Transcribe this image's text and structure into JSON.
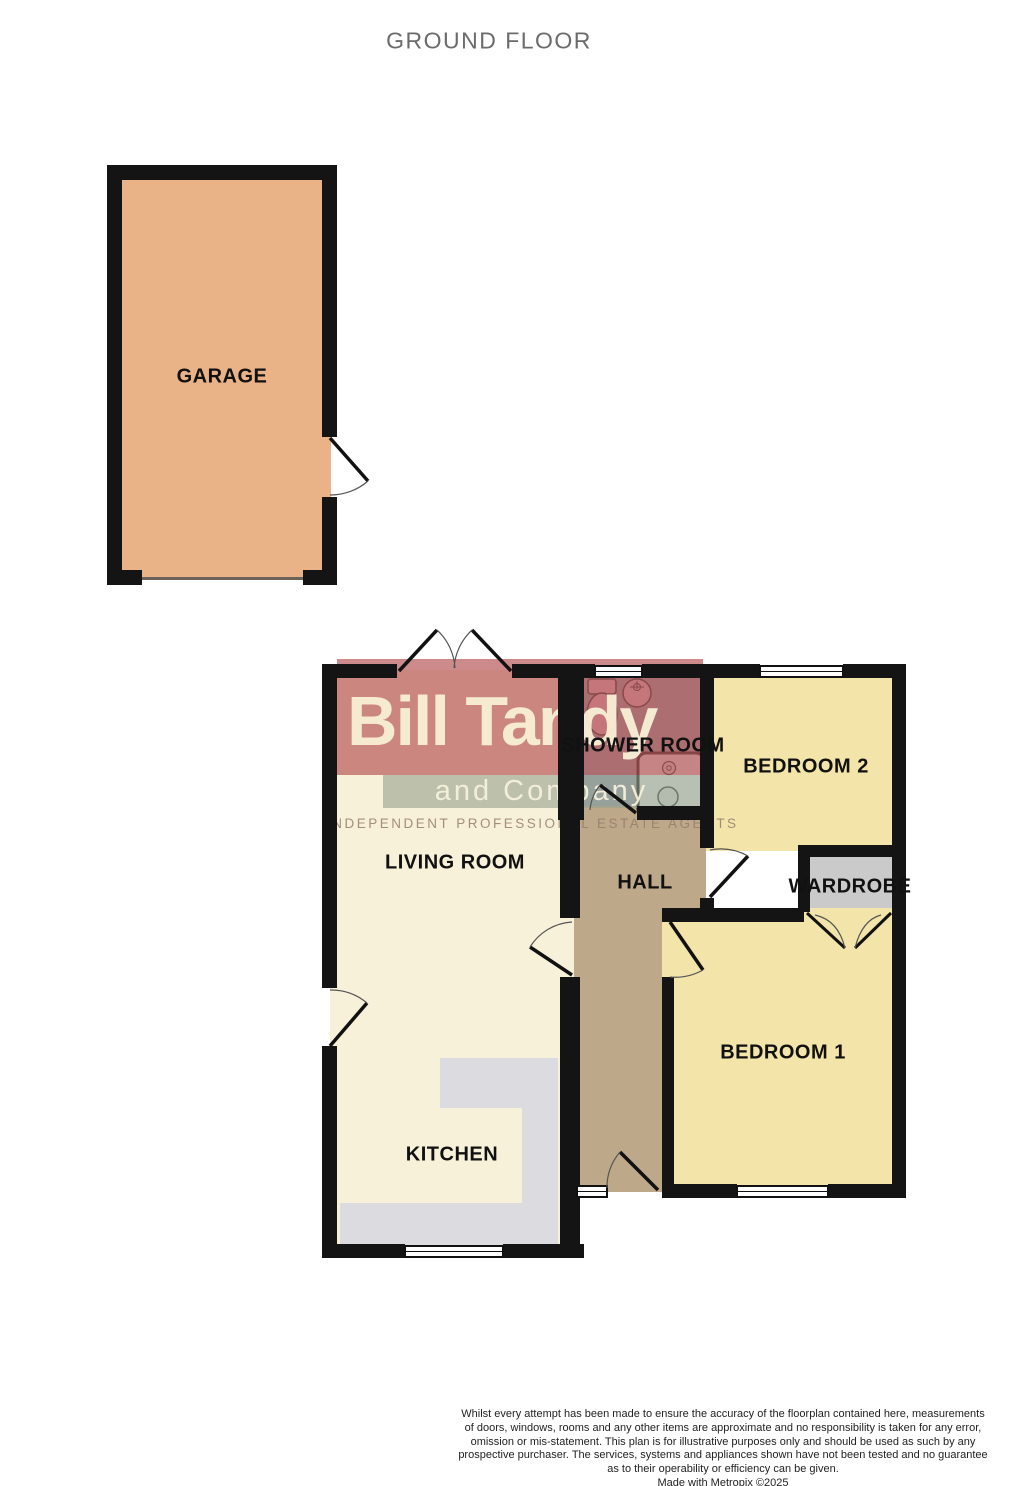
{
  "title": "GROUND FLOOR",
  "rooms": {
    "garage": "GARAGE",
    "living_room": "LIVING ROOM",
    "kitchen": "KITCHEN",
    "hall": "HALL",
    "shower_room": "SHOWER ROOM",
    "bedroom2": "BEDROOM 2",
    "bedroom1": "BEDROOM 1",
    "wardrobe": "WARDROBE"
  },
  "watermark": {
    "line1": "Bill Tandy",
    "line2": "and Company",
    "line3": "INDEPENDENT PROFESSIONAL ESTATE AGENTS"
  },
  "disclaimer": {
    "lines": [
      "Whilst every attempt has been made to ensure the accuracy of the floorplan contained here, measurements",
      "of doors, windows, rooms and any other items are approximate and no responsibility is taken for any error,",
      "omission or mis-statement. This plan is for illustrative purposes only and should be used as such by any",
      "prospective purchaser. The services, systems and appliances shown have not been tested and no guarantee",
      "as to their operability or efficiency can be given.",
      "Made with Metropix ©2025"
    ]
  },
  "icons": {
    "toilet": "toilet-icon",
    "sink": "sink-icon",
    "shower_tray": "shower-tray-icon",
    "windows": "window-icon",
    "doors": "door-swing-icon"
  },
  "colors": {
    "wall": "#141414",
    "garage_fill": "#eab287",
    "bedroom_fill": "#f3e4a9",
    "living_kitchen_fill": "#f8f1d9",
    "hall_fill": "#bea88a",
    "shower_room_fill": "#96a1af",
    "wardrobe_fill": "#cacaca",
    "kitchen_counter_fill": "#dcdce0",
    "watermark_red": "#b75858",
    "watermark_green": "#96a28e",
    "fixture_pink": "#e3bcc8",
    "title_gray": "#6b6b6b"
  }
}
